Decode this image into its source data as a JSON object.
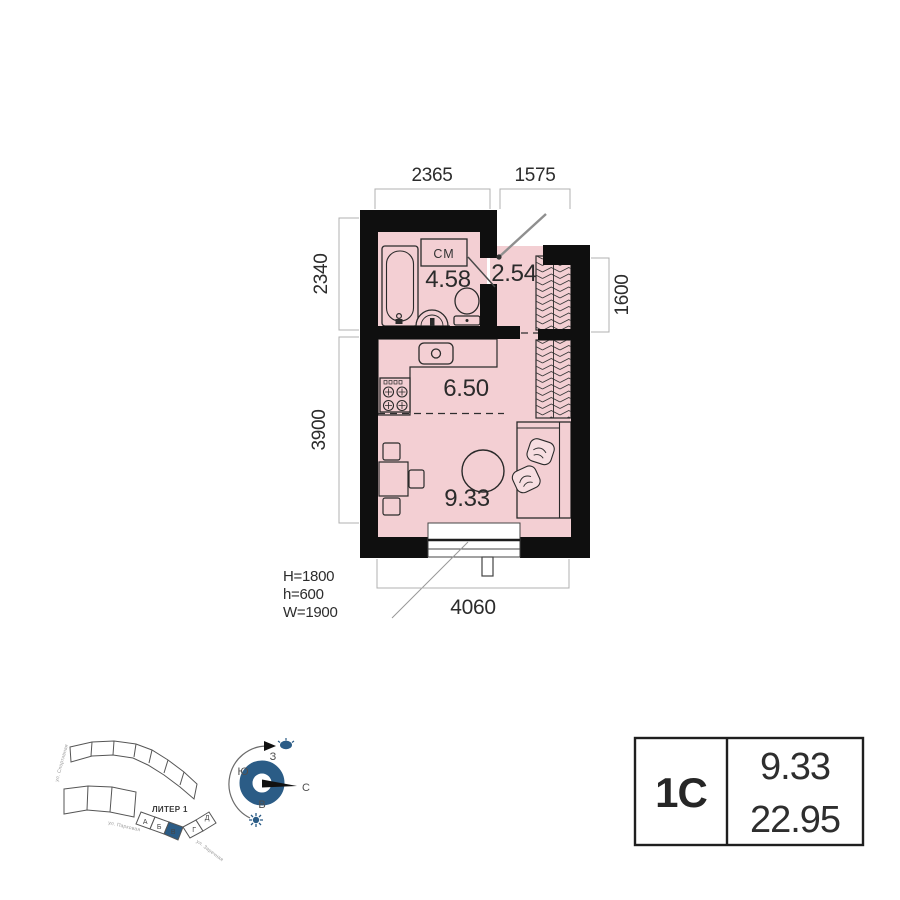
{
  "plan": {
    "rooms": [
      {
        "id": "bathroom",
        "area": "4.58"
      },
      {
        "id": "hallway",
        "area": "2.54"
      },
      {
        "id": "kitchen",
        "area": "6.50"
      },
      {
        "id": "living",
        "area": "9.33"
      }
    ],
    "fixtures": {
      "washing_machine_label": "СМ"
    },
    "dimensions": {
      "top_bathroom": "2365",
      "top_entry": "1575",
      "left_upper": "2340",
      "left_lower": "3900",
      "right_wardrobe": "1600",
      "bottom": "4060"
    },
    "window_specs": {
      "H": "H=1800",
      "h": "h=600",
      "W": "W=1900"
    }
  },
  "site_plan": {
    "building_label": "ЛИТЕР 1",
    "sections": [
      "А",
      "Б",
      "В",
      "Г",
      "Д"
    ],
    "highlighted_section": "В",
    "streets": {
      "left": "ул. Спортивная",
      "bottom": "ул. Парковая",
      "right": "ул. Заречная"
    }
  },
  "compass": {
    "west": "З",
    "south": "Ю",
    "east": "В",
    "north": "С"
  },
  "info_table": {
    "unit_type": "1С",
    "living_area": "9.33",
    "total_area": "22.95"
  },
  "colors": {
    "room_fill": "#f3cfd3",
    "wall": "#0f0f0f",
    "accent_blue": "#2b5c86"
  }
}
